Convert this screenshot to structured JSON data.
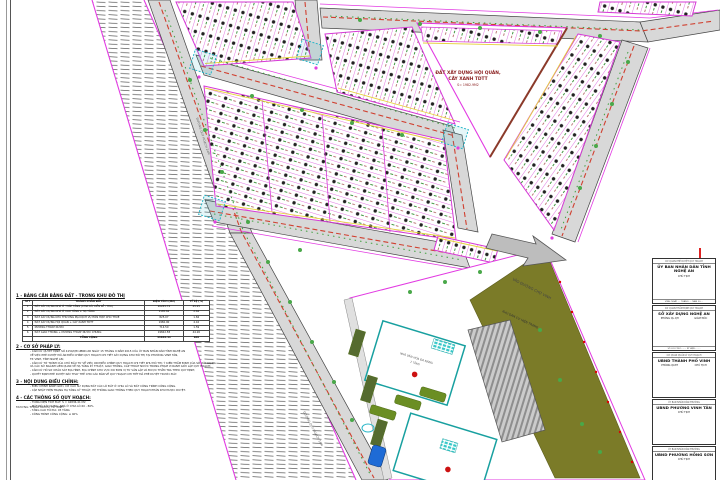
{
  "map": {
    "triangle_block": {
      "line1": "ĐẤT XÂY DỰNG HỘI QUÁN,",
      "line2": "CÂY XANH TDTT",
      "area": "S= 1982.9M2"
    },
    "arrow_label": "VÀO ĐƯỜNG CHỢ VINH",
    "existing_label": "KHU DÂN CƯ HIỆN TRẠNG",
    "road1_label": "ĐƯỜNG QUY HOẠCH 24M",
    "road2_label": "ĐƯỜNG QUY HOẠCH 16M",
    "canal_label": "MƯƠNG THOÁT NƯỚC TP. VINH",
    "facility": {
      "line1": "NHÀ VĂN HÓA ĐA NĂNG",
      "line2": "2 TẦNG"
    },
    "colors": {
      "road_fill": "#d8d8d8",
      "boundary_magenta": "#e23ae2",
      "lot_line_magenta": "#d63ad6",
      "front_yellow": "#e6d23e",
      "centerline_red": "#d04030",
      "tree_green": "#49a849",
      "landscape_olive": "#7b7b28",
      "building_teal": "#18a0a0",
      "junction_cyan": "#29b6c8"
    }
  },
  "notes": {
    "s1": {
      "title": "1 - BẢNG CÂN BẰNG ĐẤT - TRONG KHU ĐÔ THỊ",
      "table": {
        "headers": [
          "STT",
          "THÀNH PHẦN ĐẤT",
          "DIỆN TÍCH (M2)",
          "TỶ LỆ (%)"
        ],
        "rows": [
          [
            "1",
            "ĐẤT XÂY DỰNG NHÀ Ở THẤP TẦNG (CHIA LÔ, LIỀN KỀ - TĐC)",
            "20285.74",
            "45.25"
          ],
          [
            "2",
            "ĐẤT XÂY DỰNG NHÀ Ở CAO TẦNG + HẠ TẦNG",
            "1185.62",
            "2.64"
          ],
          [
            "3",
            "ĐẤT XÂY DỰNG KHU THƯƠNG MẠI DỊCH VỤ HỖN HỢP CHO THUÊ",
            "825.07",
            "1.84"
          ],
          [
            "4",
            "ĐẤT XÂY DỰNG HỘI QUÁN + CÂY XANH TDTT",
            "1982.90",
            "4.42"
          ],
          [
            "5",
            "MƯƠNG THOÁT NƯỚC",
            "714.50",
            "1.59"
          ],
          [
            "6",
            "ĐẤT GIAO THÔNG + MƯƠNG THOÁT NƯỚC CHUNG",
            "19842.58",
            "44.26"
          ]
        ],
        "total_row": [
          "",
          "TỔNG CỘNG",
          "44836.41",
          "100"
        ]
      }
    },
    "s2": {
      "title": "2 - CƠ SỞ PHÁP LÝ:",
      "lines": [
        "- CĂN CỨ QUYẾT ĐỊNH SỐ 4150/QĐ.UBND-XD NGÀY 15 THÁNG 9 NĂM 2015 CỦA ỦY BAN NHÂN DÂN TỈNH NGHỆ AN",
        "VỀ VIỆC PHÊ DUYỆT ĐỒ ÁN ĐIỀU CHỈNH QUY HOẠCH CHI TIẾT XÂY DỰNG KHU ĐÔ THỊ TẠI PHƯỜNG VINH TÂN,",
        "TP. VINH, TỈNH NGHỆ AN;",
        "- CĂN CỨ TỜ TRÌNH CỦA CHỦ ĐẦU TƯ VỀ VIỆC XIN ĐIỀU CHỈNH QUY HOẠCH CHI TIẾT KHU ĐÔ THỊ; Ý KIẾN THẨM ĐỊNH CỦA SỞ XÂY DỰNG",
        "VÀ CÁC SỞ NGÀNH LIÊN QUAN VỀ HẠ TẦNG KỸ THUẬT, GIAO THÔNG, CẤP THOÁT NƯỚC TRONG PHẠM VI RANH GIỚI LẬP QUY HOẠCH;",
        "- CĂN CỨ HỒ SƠ KHẢO SÁT ĐỊA HÌNH, ĐỊA CHÍNH KHU VỰC DO ĐƠN VỊ TƯ VẤN LẬP VÀ ĐƯỢC THẨM TRA THEO QUY ĐỊNH;",
        "- QUYẾT ĐỊNH PHÊ DUYỆT NÀY THAY THẾ CHO CÁC BẢN VẼ QUY HOẠCH CHI TIẾT ĐÃ PHÊ DUYỆT TRƯỚC ĐÂY."
      ]
    },
    "s3": {
      "title": "3 - NỘI DUNG ĐIỀU CHỈNH:",
      "lines": [
        "- ĐIỀU CHỈNH RANH GIỚI, CƠ CẤU SỬ DỤNG ĐẤT CÁC LÔ ĐẤT Ở CHIA LÔ VÀ ĐẤT CÔNG TRÌNH CÔNG CỘNG.",
        "- CẬP NHẬT HIỆN TRẠNG HẠ TẦNG KỸ THUẬT, HỆ THỐNG GIAO THÔNG THEO QUY HOẠCH PHÂN KHU ĐƯỢC DUYỆT."
      ]
    },
    "s4": {
      "title": "4 - CÁC THÔNG SỐ QUY HOẠCH:",
      "lines": [
        "- TỔNG DIỆN TÍCH ĐẤT:   S = 44836.41 M2",
        "- MẬT ĐỘ XÂY DỰNG:   NHÀ Ở CHIA LÔ 60 - 80%",
        "- TẦNG CAO TỐI ĐA:   05 TẦNG",
        "- CÔNG TRÌNH CÔNG CỘNG:   ≤ 40%"
      ]
    }
  },
  "title_blocks": [
    {
      "caption": "CƠ QUAN PHÊ DUYỆT QUY HOẠCH",
      "name": "ỦY BAN NHÂN DÂN TỈNH NGHỆ AN",
      "sub1": "CHỦ TỊCH",
      "sub2": "",
      "footer": "VINH, NGÀY .... THÁNG .... NĂM 20...."
    },
    {
      "caption": "CƠ QUAN THẨM ĐỊNH QUY HOẠCH",
      "name": "SỞ XÂY DỰNG NGHỆ AN",
      "sub1": "PHÒNG QL.QH",
      "sub2": "GIÁM ĐỐC",
      "footer": "SỐ LƯU TRỮ: ......    KÝ HIỆU: ......"
    },
    {
      "caption": "CƠ QUAN QUẢN LÝ QUY HOẠCH",
      "name": "UBND THÀNH PHỐ VINH",
      "sub1": "PHÒNG QLĐT",
      "sub2": "CHỦ TỊCH",
      "footer": ""
    },
    {
      "caption": "ỦY BAN NHÂN DÂN PHƯỜNG",
      "name": "UBND PHƯỜNG VINH TÂN",
      "sub1": "CHỦ TỊCH",
      "sub2": "",
      "footer": ""
    },
    {
      "caption": "ỦY BAN NHÂN DÂN PHƯỜNG",
      "name": "UBND PHƯỜNG HỒNG SƠN",
      "sub1": "CHỦ TỊCH",
      "sub2": "",
      "footer": ""
    }
  ]
}
